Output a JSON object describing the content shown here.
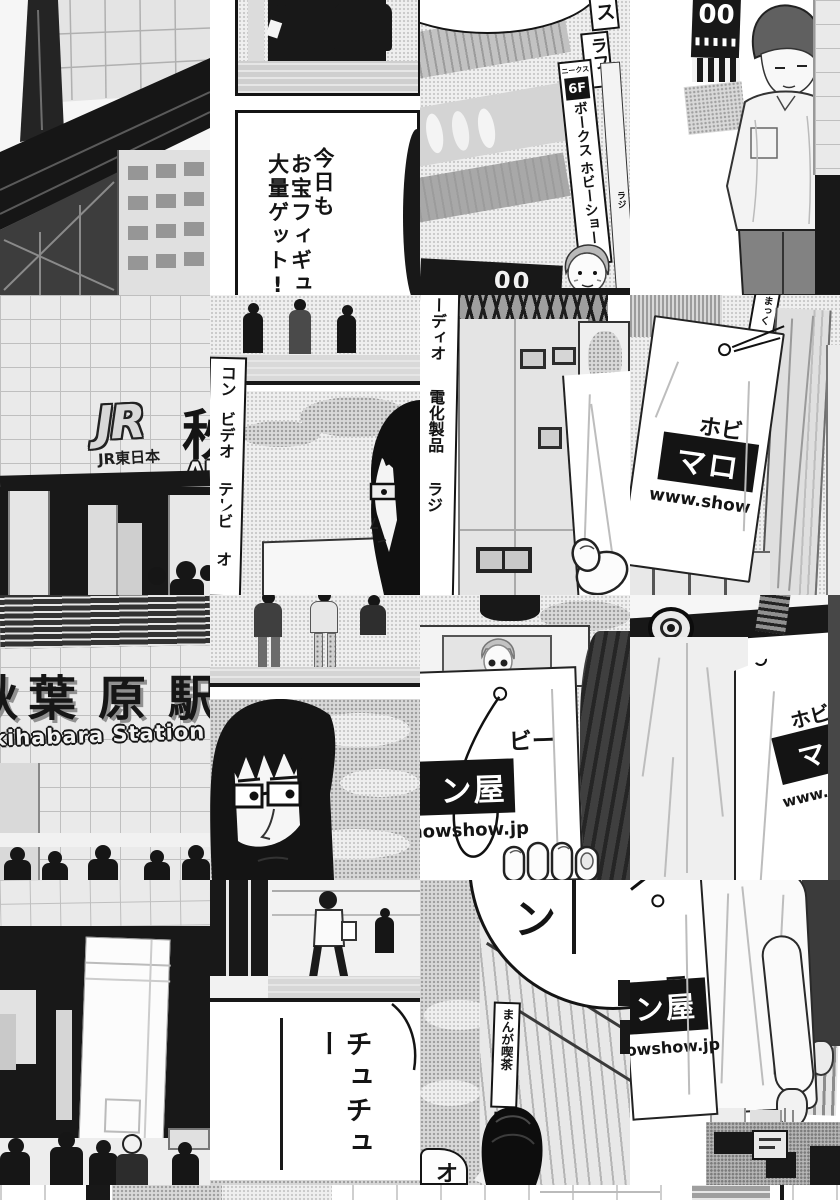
{
  "page": {
    "type": "manga-page-tiles",
    "description": "Black-and-white manga page cut into a shuffled 4x4 tile grid plus a thin bottom strip: Akihabara station facade, electric-town street signs, a woman with glasses, and hobby-shop shopping bags",
    "colors": {
      "paper": "#ffffff",
      "ink": "#181818",
      "halftone_light": "#efefef",
      "halftone_mid": "#d8d8d8"
    }
  },
  "texts": {
    "bubble_today": {
      "l1": "今日も",
      "l2": "お宝フィギュア",
      "l3": "大量ゲット!!"
    },
    "volks": {
      "small": "ニークス",
      "floor": "6F",
      "name": "ボークス",
      "event": "ホビーショー"
    },
    "partials": {
      "su": "ス",
      "rafu": "ラフ",
      "raji": "ラジ",
      "zeros_street": "00",
      "zeros_sign": "00"
    },
    "jr": {
      "logo": "JR",
      "company": "JR東日本",
      "kanji": "秋",
      "latin": "Ak"
    },
    "elec_left": {
      "l1": "コン",
      "l2": "ビデオ",
      "l3": "テレビ",
      "l4": "オ"
    },
    "elec_right": {
      "l1": "ーディオ",
      "l2": "電化製品",
      "l3": "ラジ"
    },
    "bag_r2c4": {
      "brand": "ホビ",
      "logo": "マロ",
      "url": "www.show"
    },
    "bag_r3c3": {
      "brand": "ビー",
      "logo": "ン屋",
      "url": "howshow.jp"
    },
    "bag_r3c4": {
      "brand": "ホビ",
      "logo": "マ",
      "url": "www.s"
    },
    "bag_r4c4": {
      "brand": "ー",
      "logo": "ン屋",
      "url": "owshow.jp"
    },
    "station": {
      "kanji": "葉原駅",
      "kanji_cut": "秋",
      "latin": "kihabara Station"
    },
    "makku": "まっく",
    "chu": "チュチュー",
    "n_char": "ン",
    "manga_cafe": "まんが喫茶",
    "o_char": "オ"
  }
}
